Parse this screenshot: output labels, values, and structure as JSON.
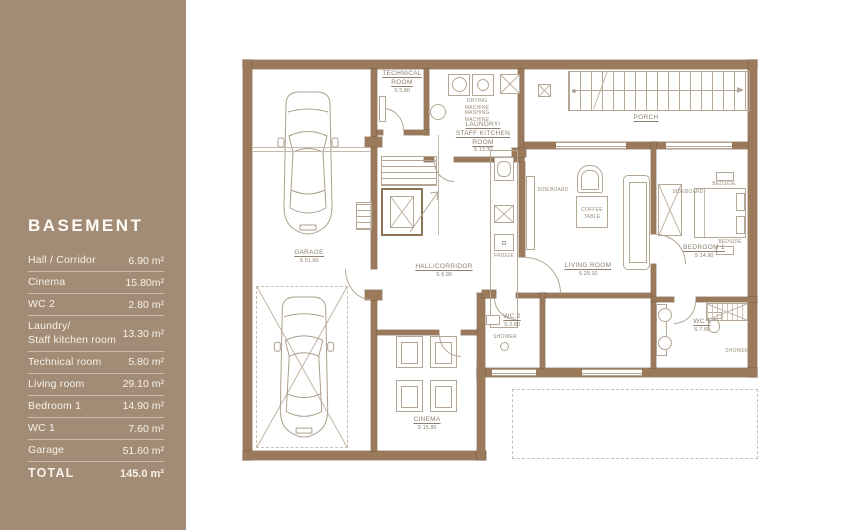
{
  "sidebar": {
    "title": "BASEMENT",
    "rows": [
      {
        "label": "Hall / Corridor",
        "value": "6.90 m²"
      },
      {
        "label": "Cinema",
        "value": "15.80m²"
      },
      {
        "label": "WC 2",
        "value": "2.80 m²"
      },
      {
        "label": "Laundry/\nStaff kitchen room",
        "value": "13.30 m²"
      },
      {
        "label": "Technical room",
        "value": "5.80 m²"
      },
      {
        "label": "Living room",
        "value": "29.10 m²"
      },
      {
        "label": "Bedroom 1",
        "value": "14.90 m²"
      },
      {
        "label": "WC 1",
        "value": "7.60 m²"
      },
      {
        "label": "Garage",
        "value": "51.60 m²"
      },
      {
        "label": "TOTAL",
        "value": "145.0 m²"
      }
    ]
  },
  "plan": {
    "rooms": {
      "technical": {
        "line1": "TECHNICAL",
        "line2": "ROOM",
        "area": "S 5.80"
      },
      "laundry": {
        "line1": "LAUNDRY/",
        "line2": "STAFF KITCHEN ROOM",
        "area": "S 13.30"
      },
      "porch": {
        "line1": "PORCH"
      },
      "garage": {
        "line1": "GARAGE",
        "area": "S 51.60"
      },
      "hall": {
        "line1": "HALL/CORRIDOR",
        "area": "S 6.90"
      },
      "living": {
        "line1": "LIVING ROOM",
        "area": "S 29.10"
      },
      "bedroom": {
        "line1": "BEDROOM 1",
        "area": "S 14.90"
      },
      "wc2": {
        "line1": "WC 2",
        "area": "S 2.80"
      },
      "wc1": {
        "line1": "WC 1",
        "area": "S 7.60"
      },
      "cinema": {
        "line1": "CINEMA",
        "area": "S 15.80"
      }
    },
    "labels": {
      "drying_machine": "DRYING MACHINE",
      "washing_machine": "WASHING MACHINE",
      "sideboard": "SIDEBOARD",
      "coffee_table": "COFFEE TABLE",
      "bedside": "BEDSIDE",
      "fridge": "FRIDGE",
      "shower": "SHOWER"
    }
  },
  "colors": {
    "sidebar": "#a28c75",
    "wall": "#9a7a5a",
    "line": "#b3a694",
    "text": "#8d8070"
  }
}
